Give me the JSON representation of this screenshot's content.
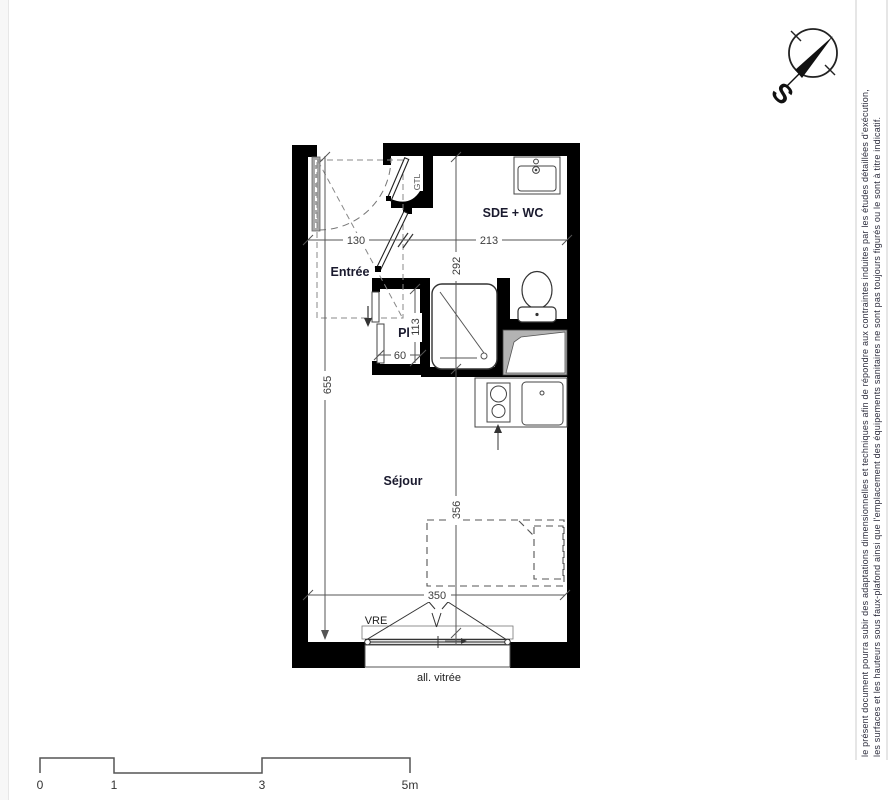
{
  "plan": {
    "rooms": {
      "entree": "Entrée",
      "sde_wc": "SDE + WC",
      "placard": "Pl",
      "sejour": "Séjour",
      "gtl": "GTL"
    },
    "dimensions": {
      "d130": "130",
      "d213": "213",
      "d292": "292",
      "d113": "113",
      "d60": "60",
      "d655": "655",
      "d356": "356",
      "d350": "350"
    },
    "window": {
      "vre": "VRE",
      "allege": "all. vitrée"
    }
  },
  "compass": {
    "south": "S"
  },
  "disclaimer": {
    "line1": "le présent document pourra subir des adaptations dimensionnelles et techniques afin de répondre aux contraintes induites par les études détaillées d'exécution,",
    "line2": "les surfaces et les hauteurs sous faux-plafond ainsi que l'emplacement des équipements sanitaires ne sont pas toujours figurés ou le sont à titre indicatif."
  },
  "scalebar": {
    "t0": "0",
    "t1": "1",
    "t3": "3",
    "t5": "5m"
  },
  "colors": {
    "wall": "#000000",
    "room_label": "#1a1a2e",
    "dimension": "#3d3d3d",
    "fixture_line": "#444444",
    "duct_gray": "#b3b3b3"
  }
}
